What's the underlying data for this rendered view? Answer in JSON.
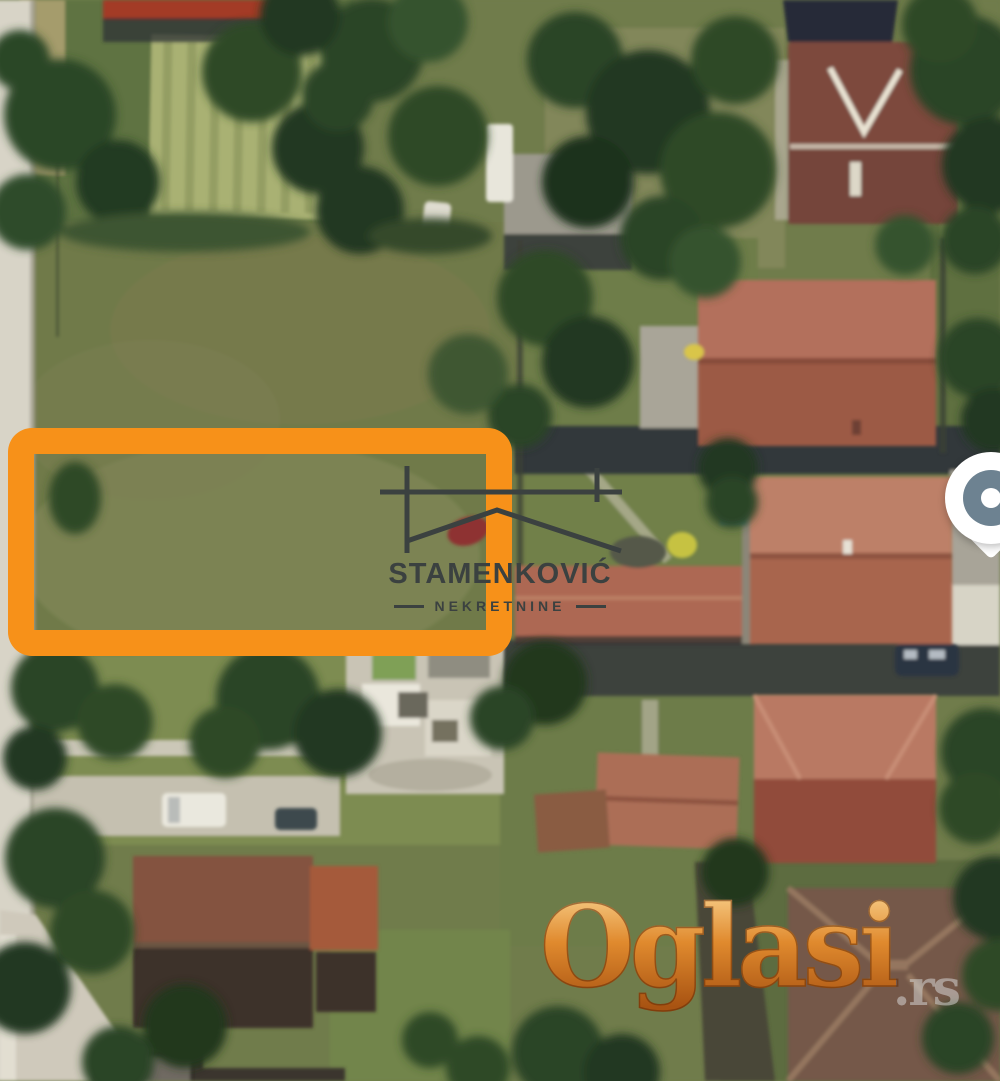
{
  "branding": {
    "agency_name": "STAMENKOVIĆ",
    "agency_subtitle": "NEKRETNINE"
  },
  "watermark": {
    "site_name": "Oglasi",
    "site_tld": ".rs"
  },
  "icons": {
    "logo_mark": "house-outline",
    "map_marker": "location-pin"
  },
  "colors": {
    "highlight": "#f79119",
    "logo": "#3b4140",
    "pin": "#6d8291",
    "wm_light": "#f8cf8a",
    "wm_dark": "#a85312"
  }
}
